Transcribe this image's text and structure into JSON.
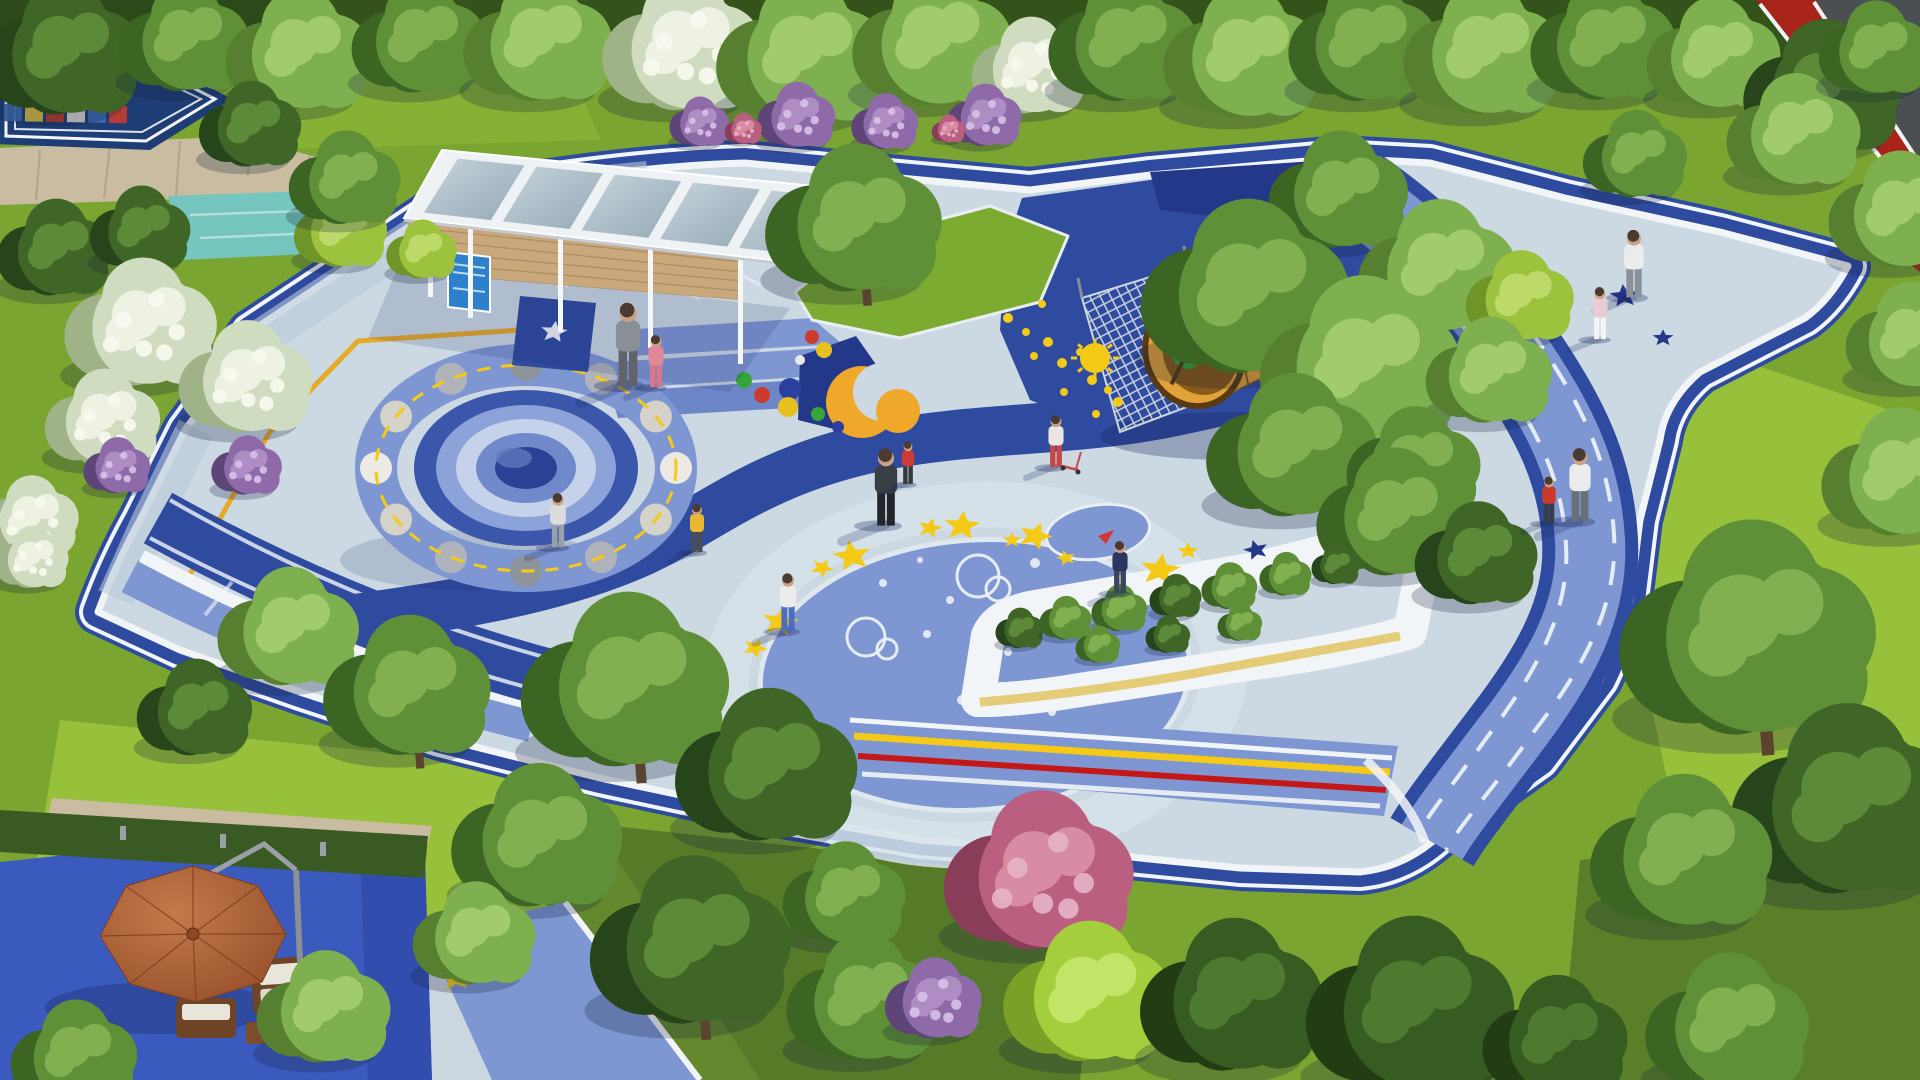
{
  "scene": {
    "alt_text": "Aerial 3D rendering of a space-themed children's playground in a park: blue rubber plaza with crater mound, moon-phase ring, yellow stars, orange rocket tunnel with climbing nets, white glass-roof pavilion, yellow seating wall around shrubs, blue running loop, game court, terracotta umbrella lounge, surrounded by lawns and trees"
  },
  "palette": {
    "grass": "#79a530",
    "grassLight": "#97c03b",
    "grassDark": "#3a5a22",
    "grassDeep": "#2c4a19",
    "pavementLight": "#ccd9e3",
    "pavementTint": "#b9c9d8",
    "medBlue": "#7e97d3",
    "medBlue2": "#6d86c8",
    "navy": "#2f4ba0",
    "navyDeep": "#24388a",
    "courtNavy": "#1e3d74",
    "white": "#f2f5f7",
    "yellow": "#f4ca16",
    "yellowLine": "#e8a81c",
    "orange": "#f0a82a",
    "red": "#c41818",
    "trackRed": "#a82418",
    "asphalt": "#4a4f52",
    "teal": "#74c6be",
    "sand": "#c9bca0",
    "wood": "#c9a87c",
    "woodDark": "#a5845c",
    "frameWhite": "#eef2f4",
    "poster": "#2f80cc",
    "umbrellaDark": "#8c4723",
    "wicker": "#6e4426",
    "cushion": "#e9e5da",
    "rocketBody": "#e2a23a",
    "rocketRim": "#5a3a12",
    "rocketInner": "#8a5a1a",
    "rocketGreen": "#2fa83c",
    "rocketFin": "#f2c83c",
    "benchYellow": "#f2cc1e",
    "benchShade": "#d9a90f",
    "bedGreen": "#5d8f35",
    "shadow": "#16245c",
    "groundBlue": "#3b5abe"
  },
  "tree_types": {
    "g1": {
      "base": "#5f9038",
      "light": "#82b050",
      "dark": "#3c6423"
    },
    "g2": {
      "base": "#7fb050",
      "light": "#a2cc6c",
      "dark": "#567f30"
    },
    "g3": {
      "base": "#3f6626",
      "light": "#5c8a38",
      "dark": "#27451a"
    },
    "lm": {
      "base": "#9cc23e",
      "light": "#bcd96a",
      "dark": "#6f9428"
    },
    "bw": {
      "base": "#cfdcc0",
      "light": "#eef2e2",
      "dark": "#9fb288",
      "dotc": "#f8faf0"
    },
    "pu": {
      "base": "#8f6aa8",
      "light": "#b08cc4",
      "dark": "#5f4478",
      "dotc": "#d8c2e8"
    },
    "pk": {
      "base": "#bb5f80",
      "light": "#d88ca4",
      "dark": "#8a3d58",
      "dotc": "#e8b4c8"
    },
    "sd": {
      "base": "#375c22",
      "light": "#4e7a30",
      "dark": "#223d14"
    },
    "lb": {
      "base": "#a4ce3c",
      "light": "#c4e468",
      "dark": "#7aa028"
    }
  },
  "trees": [
    [
      70,
      55,
      85,
      "g3"
    ],
    [
      190,
      42,
      70,
      "g1"
    ],
    [
      305,
      55,
      78,
      "g2"
    ],
    [
      425,
      42,
      72,
      "g1"
    ],
    [
      545,
      45,
      80,
      "g2"
    ],
    [
      690,
      50,
      86,
      "bw"
    ],
    [
      810,
      58,
      92,
      "g2"
    ],
    [
      940,
      45,
      86,
      "g2"
    ],
    [
      1035,
      70,
      62,
      "bw"
    ],
    [
      1130,
      45,
      80,
      "g1"
    ],
    [
      1250,
      58,
      85,
      "g2"
    ],
    [
      1370,
      45,
      80,
      "g1"
    ],
    [
      1490,
      55,
      85,
      "g2"
    ],
    [
      1610,
      45,
      78,
      "g1"
    ],
    [
      1720,
      58,
      72,
      "g2"
    ],
    [
      1830,
      92,
      85,
      "g3"
    ],
    [
      1905,
      215,
      75,
      "g2"
    ],
    [
      1800,
      135,
      72,
      "g2"
    ],
    [
      1880,
      52,
      60,
      "g1"
    ],
    [
      255,
      128,
      55,
      "g3"
    ],
    [
      800,
      118,
      42,
      "pu"
    ],
    [
      888,
      124,
      36,
      "pu"
    ],
    [
      988,
      118,
      40,
      "pu"
    ],
    [
      702,
      124,
      32,
      "pu"
    ],
    [
      745,
      130,
      20,
      "pk"
    ],
    [
      950,
      130,
      18,
      "pk"
    ],
    [
      60,
      252,
      62,
      "g3"
    ],
    [
      145,
      232,
      54,
      "g3"
    ],
    [
      345,
      232,
      50,
      "lm"
    ],
    [
      425,
      252,
      38,
      "lm"
    ],
    [
      350,
      182,
      60,
      "g1"
    ],
    [
      148,
      328,
      82,
      "bw"
    ],
    [
      252,
      382,
      72,
      "bw"
    ],
    [
      108,
      422,
      62,
      "bw"
    ],
    [
      35,
      520,
      52,
      "bw"
    ],
    [
      250,
      468,
      38,
      "pu"
    ],
    [
      120,
      468,
      36,
      "pu"
    ],
    [
      35,
      560,
      40,
      "bw"
    ],
    [
      862,
      225,
      95,
      "g1",
      1
    ],
    [
      1640,
      158,
      56,
      "g1"
    ],
    [
      1345,
      195,
      75,
      "g1"
    ],
    [
      1445,
      272,
      85,
      "g2"
    ],
    [
      1255,
      295,
      112,
      "g1"
    ],
    [
      1525,
      300,
      58,
      "lm"
    ],
    [
      1370,
      368,
      108,
      "g2"
    ],
    [
      1300,
      452,
      92,
      "g1"
    ],
    [
      1495,
      375,
      68,
      "g2"
    ],
    [
      1420,
      468,
      72,
      "g1"
    ],
    [
      1400,
      518,
      82,
      "g1"
    ],
    [
      1482,
      558,
      66,
      "g3"
    ],
    [
      1915,
      340,
      68,
      "g2"
    ],
    [
      1905,
      478,
      82,
      "g2"
    ],
    [
      1760,
      638,
      138,
      "g1",
      1
    ],
    [
      1855,
      808,
      122,
      "g3"
    ],
    [
      1690,
      858,
      98,
      "g1"
    ],
    [
      1022,
      630,
      26,
      "g3"
    ],
    [
      1068,
      620,
      28,
      "g1"
    ],
    [
      1122,
      610,
      30,
      "g1"
    ],
    [
      1178,
      598,
      28,
      "g3"
    ],
    [
      1232,
      588,
      30,
      "g1"
    ],
    [
      1288,
      576,
      28,
      "g1"
    ],
    [
      1338,
      566,
      26,
      "g3"
    ],
    [
      1100,
      646,
      24,
      "g1"
    ],
    [
      1170,
      636,
      24,
      "g3"
    ],
    [
      1242,
      624,
      24,
      "g1"
    ],
    [
      295,
      632,
      76,
      "g2"
    ],
    [
      415,
      692,
      90,
      "g1",
      1
    ],
    [
      200,
      712,
      62,
      "g3"
    ],
    [
      635,
      688,
      112,
      "g1",
      1
    ],
    [
      775,
      772,
      98,
      "g3"
    ],
    [
      545,
      842,
      92,
      "g1"
    ],
    [
      480,
      938,
      66,
      "g2"
    ],
    [
      850,
      898,
      66,
      "g1"
    ],
    [
      700,
      948,
      108,
      "g3",
      1
    ],
    [
      870,
      1003,
      82,
      "g1"
    ],
    [
      1048,
      878,
      102,
      "pk",
      1
    ],
    [
      938,
      1002,
      52,
      "pu"
    ],
    [
      1095,
      998,
      90,
      "lb"
    ],
    [
      1240,
      1002,
      98,
      "sd"
    ],
    [
      1420,
      1012,
      112,
      "sd"
    ],
    [
      1562,
      1042,
      78,
      "sd"
    ],
    [
      1735,
      1028,
      88,
      "g1"
    ],
    [
      80,
      1058,
      68,
      "g1"
    ],
    [
      330,
      1012,
      72,
      "g2"
    ]
  ],
  "people": [
    [
      628,
      384,
      86,
      "#8a8f96",
      "#60646a",
      ""
    ],
    [
      656,
      386,
      54,
      "#e08898",
      "#d8788a",
      ""
    ],
    [
      558,
      546,
      56,
      "#dcdcdc",
      "#9aa0a8",
      ""
    ],
    [
      697,
      551,
      50,
      "#e8b830",
      "#4a4e54",
      ""
    ],
    [
      886,
      524,
      80,
      "#3a3f46",
      "#23262b",
      ""
    ],
    [
      1056,
      466,
      54,
      "#eae4e2",
      "#c44848",
      "scooter"
    ],
    [
      788,
      630,
      60,
      "#ececec",
      "#4d6dc0",
      ""
    ],
    [
      1120,
      592,
      54,
      "#2c3560",
      "#3c465a",
      "plane"
    ],
    [
      908,
      483,
      44,
      "#cc3b35",
      "#35383d",
      ""
    ],
    [
      1634,
      296,
      70,
      "#ececec",
      "#8a9098",
      ""
    ],
    [
      1600,
      338,
      54,
      "#e8ccd4",
      "#f4f4f4",
      ""
    ],
    [
      1580,
      520,
      76,
      "#ececec",
      "#6a7078",
      ""
    ],
    [
      1549,
      522,
      48,
      "#c8392e",
      "#3a3f45",
      ""
    ]
  ],
  "stars_yellow": [
    [
      852,
      556,
      20,
      -10
    ],
    [
      930,
      528,
      13,
      15
    ],
    [
      962,
      526,
      19,
      5
    ],
    [
      1012,
      540,
      10,
      0
    ],
    [
      1035,
      536,
      18,
      20
    ],
    [
      1066,
      558,
      10,
      -15
    ],
    [
      822,
      568,
      12,
      30
    ],
    [
      780,
      622,
      19,
      10
    ],
    [
      1160,
      570,
      21,
      8
    ],
    [
      1188,
      551,
      11,
      0
    ],
    [
      755,
      648,
      13,
      25
    ],
    [
      455,
      978,
      17,
      -8
    ],
    [
      500,
      962,
      14,
      10
    ]
  ],
  "stars_navy": [
    [
      1550,
      292,
      21,
      10
    ],
    [
      1624,
      296,
      15,
      -5
    ],
    [
      1663,
      338,
      11,
      0
    ],
    [
      1506,
      282,
      10,
      0
    ],
    [
      1256,
      550,
      13,
      -15
    ],
    [
      1304,
      240,
      11,
      0
    ]
  ],
  "stars_white": [
    [
      554,
      332,
      14,
      8
    ],
    [
      562,
      282,
      10,
      -6
    ]
  ],
  "dots": [
    [
      744,
      380,
      8,
      "#35a43a"
    ],
    [
      762,
      395,
      8,
      "#cc3b30"
    ],
    [
      790,
      389,
      11,
      "#2b3f9e"
    ],
    [
      788,
      407,
      10,
      "#e8c020"
    ],
    [
      812,
      337,
      7,
      "#cc3b30"
    ],
    [
      824,
      350,
      8,
      "#e8c020"
    ],
    [
      818,
      414,
      7,
      "#35a43a"
    ],
    [
      838,
      427,
      6,
      "#2b3f9e"
    ],
    [
      800,
      360,
      5,
      "#e8e8e8"
    ]
  ],
  "bubbles": [
    [
      978,
      576,
      21
    ],
    [
      998,
      589,
      12
    ],
    [
      866,
      637,
      19
    ],
    [
      887,
      649,
      10
    ]
  ],
  "white_dots": [
    [
      950,
      600,
      4,
      0
    ],
    [
      1035,
      563,
      5,
      0
    ],
    [
      927,
      634,
      4,
      0
    ],
    [
      883,
      583,
      4,
      0
    ],
    [
      1008,
      652,
      4,
      0
    ],
    [
      962,
      700,
      5,
      0
    ],
    [
      1052,
      712,
      4,
      0
    ],
    [
      1080,
      605,
      9,
      1
    ],
    [
      920,
      560,
      3,
      0
    ]
  ],
  "mini_dots": [
    [
      1008,
      318,
      5
    ],
    [
      1026,
      332,
      4
    ],
    [
      1048,
      342,
      5
    ],
    [
      1034,
      356,
      4
    ],
    [
      1062,
      363,
      5
    ],
    [
      1080,
      352,
      4
    ],
    [
      1092,
      380,
      5
    ],
    [
      1108,
      390,
      4
    ],
    [
      1064,
      392,
      4
    ],
    [
      1042,
      304,
      4
    ],
    [
      1118,
      402,
      5
    ],
    [
      1096,
      414,
      4
    ]
  ],
  "suns": [
    [
      1095,
      358,
      15
    ],
    [
      866,
      270,
      9
    ]
  ],
  "court_tiles": {
    "rows": [
      [
        "#c43b30",
        "#e8e4da",
        "#3f6fb5",
        "#e8c83c",
        "#c43b30",
        "#3f6fb5"
      ],
      [
        "#3f6fb5",
        "#e8c83c",
        "#c43b30",
        "#e8e4da",
        "#3f6fb5",
        "#c43b30"
      ]
    ]
  },
  "moon_ring": {
    "cx": 526,
    "cy": 468,
    "rx": 150,
    "ry": 103,
    "radius": 16,
    "colors": [
      "#eceae2",
      "#d4d2c9",
      "#b0b4ba",
      "#8e949c",
      "#b0b4ba",
      "#d4d2c9",
      "#eceae2",
      "#d4d2c9",
      "#b0b4ba",
      "#8e949c",
      "#b0b4ba",
      "#d4d2c9"
    ]
  },
  "pavilion": {
    "panels": 5
  }
}
